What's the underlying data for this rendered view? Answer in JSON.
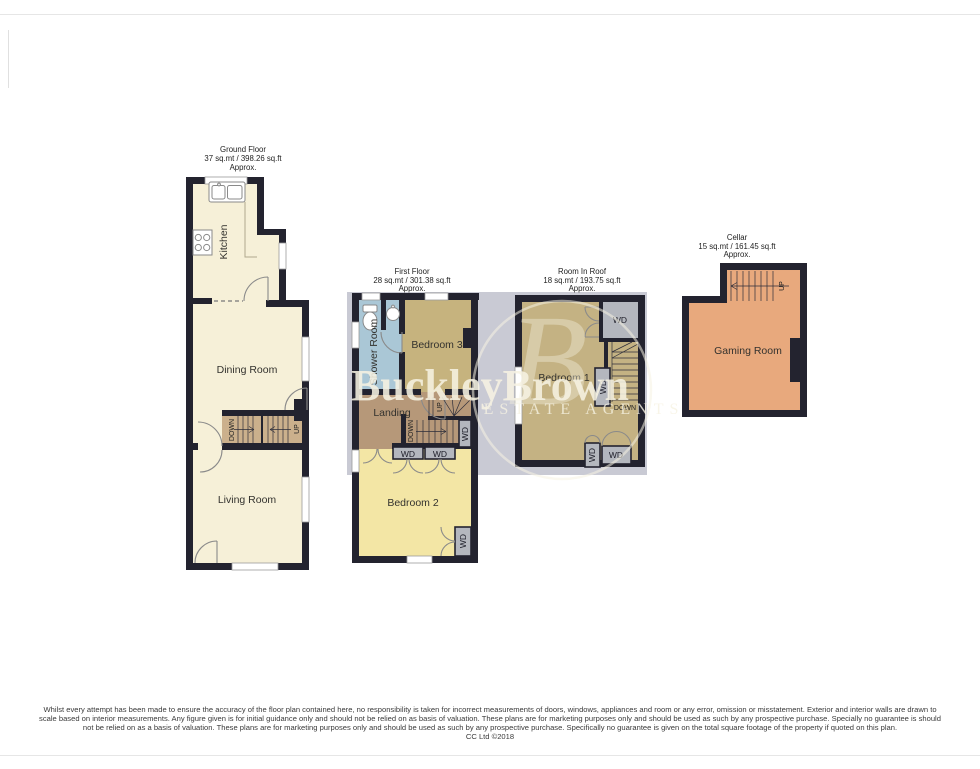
{
  "page": {
    "disclaimer_lines": [
      "Whilst every attempt has been made to ensure the accuracy of the floor plan contained here, no responsibility is taken for incorrect measurements of doors, windows, appliances and room or any error, omission or misstatement. Exterior and interior walls are drawn to",
      "scale based on interior measurements. Any figure given is for initial guidance only and should not be relied on as basis of valuation. These plans are for marketing purposes only and should be used as such by any prospective purchase. Specially no guarantee is should",
      "not be relied on as a basis of valuation. These plans are for marketing purposes only and should be used as such by any prospective purchase. Specifically no guarantee is given on the total square footage of the property if quoted on this plan."
    ],
    "copyright": "CC Ltd ©2018"
  },
  "watermark": {
    "monogram": "B",
    "brand": "BuckleyBrown",
    "tagline": "ESTATE AGENTS"
  },
  "labels": {
    "up": "UP",
    "down": "DOWN",
    "wd": "WD"
  },
  "floors": {
    "ground": {
      "title": "Ground Floor",
      "area": "37 sq.mt / 398.26 sq.ft",
      "approx": "Approx.",
      "rooms": {
        "kitchen": "Kitchen",
        "dining_room": "Dining Room",
        "living_room": "Living Room"
      }
    },
    "first": {
      "title": "First Floor",
      "area": "28 sq.mt / 301.38 sq.ft",
      "approx": "Approx.",
      "rooms": {
        "shower_room": "Shower Room",
        "bedroom3": "Bedroom 3",
        "landing": "Landing",
        "bedroom2": "Bedroom 2"
      }
    },
    "roof": {
      "title": "Room In Roof",
      "area": "18 sq.mt / 193.75 sq.ft",
      "approx": "Approx.",
      "rooms": {
        "bedroom1": "Bedroom 1"
      }
    },
    "cellar": {
      "title": "Cellar",
      "area": "15 sq.mt / 161.45 sq.ft",
      "approx": "Approx.",
      "rooms": {
        "gaming_room": "Gaming Room"
      }
    }
  },
  "colors": {
    "wall": "#23232f",
    "ground_room": "#f6f0d8",
    "stair_tan": "#cbb08c",
    "shower_blue": "#aac7d6",
    "bedroom3_khaki": "#c6b37e",
    "landing_brown": "#b69879",
    "bedroom2_yellow": "#f3e6a5",
    "bedroom1_tan": "#c4b283",
    "cellar_orange": "#e8a97d",
    "wardrobe_grey": "#b4b7be",
    "watermark_box": "#c9cad4",
    "watermark_text": "#f7f3e3"
  }
}
